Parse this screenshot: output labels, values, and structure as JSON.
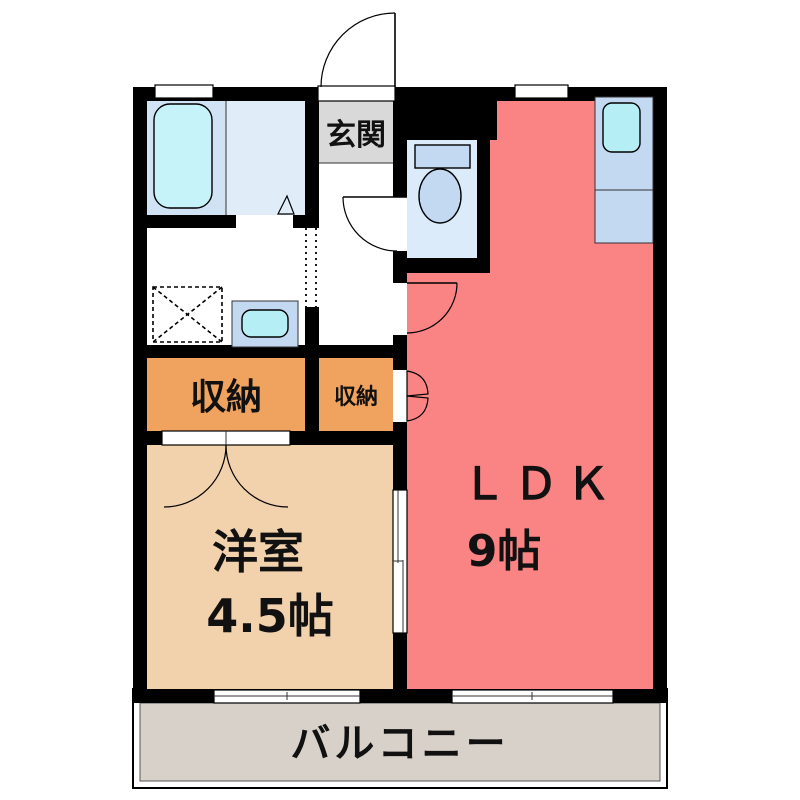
{
  "plan": {
    "rooms": {
      "entrance": {
        "label": "玄関"
      },
      "ldk": {
        "label": "ＬＤＫ",
        "size": "9帖"
      },
      "western_room": {
        "label": "洋室",
        "size": "4.5帖"
      },
      "storage_large": {
        "label": "収納"
      },
      "storage_small": {
        "label": "収納"
      },
      "balcony": {
        "label": "バルコニー"
      }
    },
    "colors": {
      "wall": "#000000",
      "ldk": "#fa8383",
      "western_room": "#f2d1ad",
      "storage": "#f0a35f",
      "genkan": "#d9d9d9",
      "balcony": "#d8d1c9",
      "bath_left": "#cfe3f5",
      "bath_right": "#e0edf9",
      "toilet_room": "#dcebfa",
      "fixture_blue": "#c3d9f2",
      "sink_cyan": "#b5eef5",
      "tub_cyan": "#c5f3f9"
    }
  }
}
